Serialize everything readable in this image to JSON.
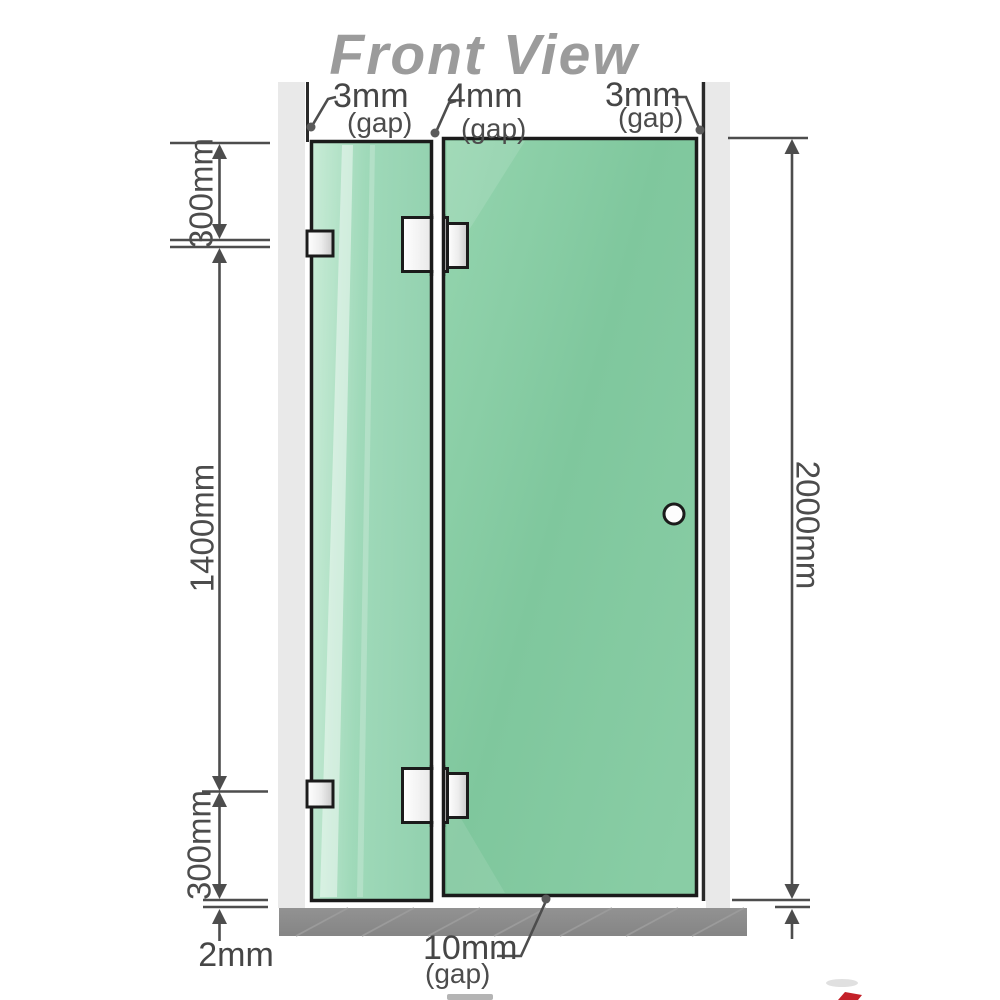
{
  "title": "Front View",
  "gap_labels": {
    "top_left": {
      "value": "3mm",
      "suffix": "(gap)"
    },
    "top_middle": {
      "value": "4mm",
      "suffix": "(gap)"
    },
    "top_right": {
      "value": "3mm",
      "suffix": "(gap)"
    },
    "bottom": {
      "value": "10mm",
      "suffix": "(gap)"
    }
  },
  "dimensions": {
    "left_top": "300mm",
    "left_middle": "1400mm",
    "left_bottom": "300mm",
    "right_total": "2000mm",
    "floor_gap": "2mm"
  },
  "colors": {
    "glass_green": "#7fc79d",
    "glass_light_green": "#a8dec2",
    "wall_post_gray": "#e9e9e9",
    "floor_gray": "#8a8a8a",
    "dimension_line": "#4d4d4d",
    "glass_outline": "#1b1b1b",
    "title_gray": "#9b9b9b",
    "accent_red": "#c42129"
  }
}
